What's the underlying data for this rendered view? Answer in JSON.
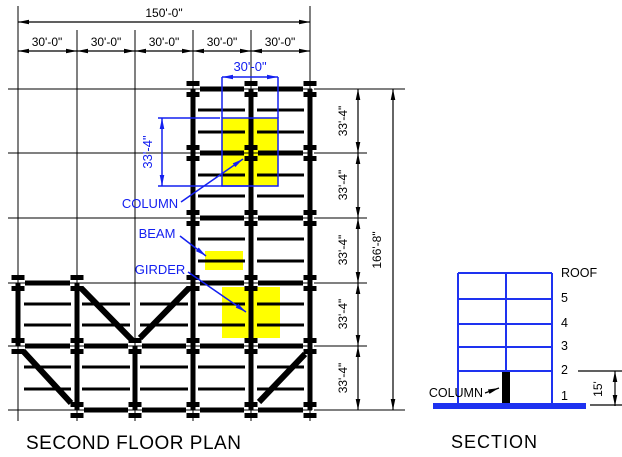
{
  "plan": {
    "title": "SECOND FLOOR PLAN",
    "overall_width": "150'-0\"",
    "bay_widths": [
      "30'-0\"",
      "30'-0\"",
      "30'-0\"",
      "30'-0\"",
      "30'-0\""
    ],
    "overall_depth": "166'-8\"",
    "bay_depths": [
      "33'-4\"",
      "33'-4\"",
      "33'-4\"",
      "33'-4\"",
      "33'-4\""
    ],
    "tributary": {
      "width": "30'-0\"",
      "depth": "33'-4\""
    },
    "labels": {
      "column": "COLUMN",
      "beam": "BEAM",
      "girder": "GIRDER"
    }
  },
  "section": {
    "title": "SECTION",
    "levels": [
      "ROOF",
      "5",
      "4",
      "3",
      "2",
      "1"
    ],
    "column_label": "COLUMN",
    "first_story_height": "15'"
  },
  "colors": {
    "highlight": "#ffff00",
    "annotation": "#1420f0",
    "frame": "#1e32f0",
    "ink": "#000000"
  }
}
